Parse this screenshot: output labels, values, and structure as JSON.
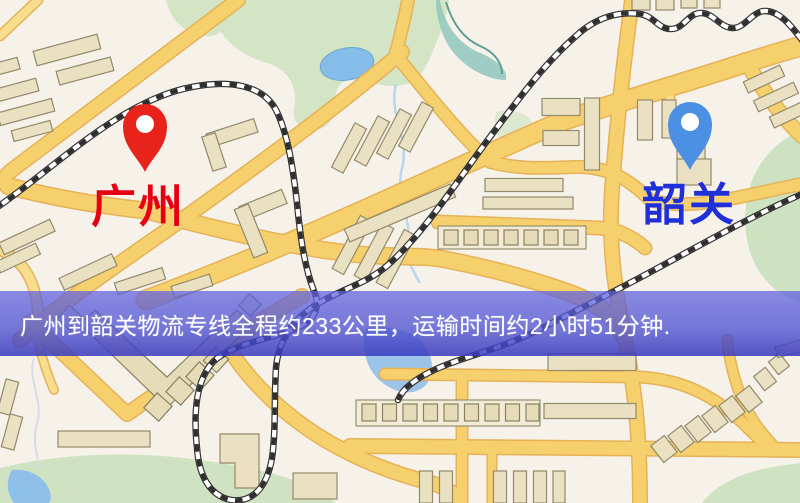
{
  "banner": {
    "text": "广州到韶关物流专线全程约233公里，运输时间约2小时51分钟."
  },
  "markers": {
    "origin": {
      "label": "广州",
      "pin_color": "#e7231a",
      "label_color": "#e60012"
    },
    "destination": {
      "label": "韶关",
      "pin_color": "#4b90e3",
      "label_color": "#2030d8"
    }
  },
  "map": {
    "background_color": "#f6f2ea",
    "road_color": "#f6d06d",
    "road_casing_color": "#e5b257",
    "park_color": "#d3e5c5",
    "water_color": "#85bde8",
    "railway_color": "#2f2f2f",
    "building_color": "#eae1c3",
    "banner_overlay_color": "rgba(82,86,211,0.78)",
    "banner_text_color": "#ffffff"
  }
}
